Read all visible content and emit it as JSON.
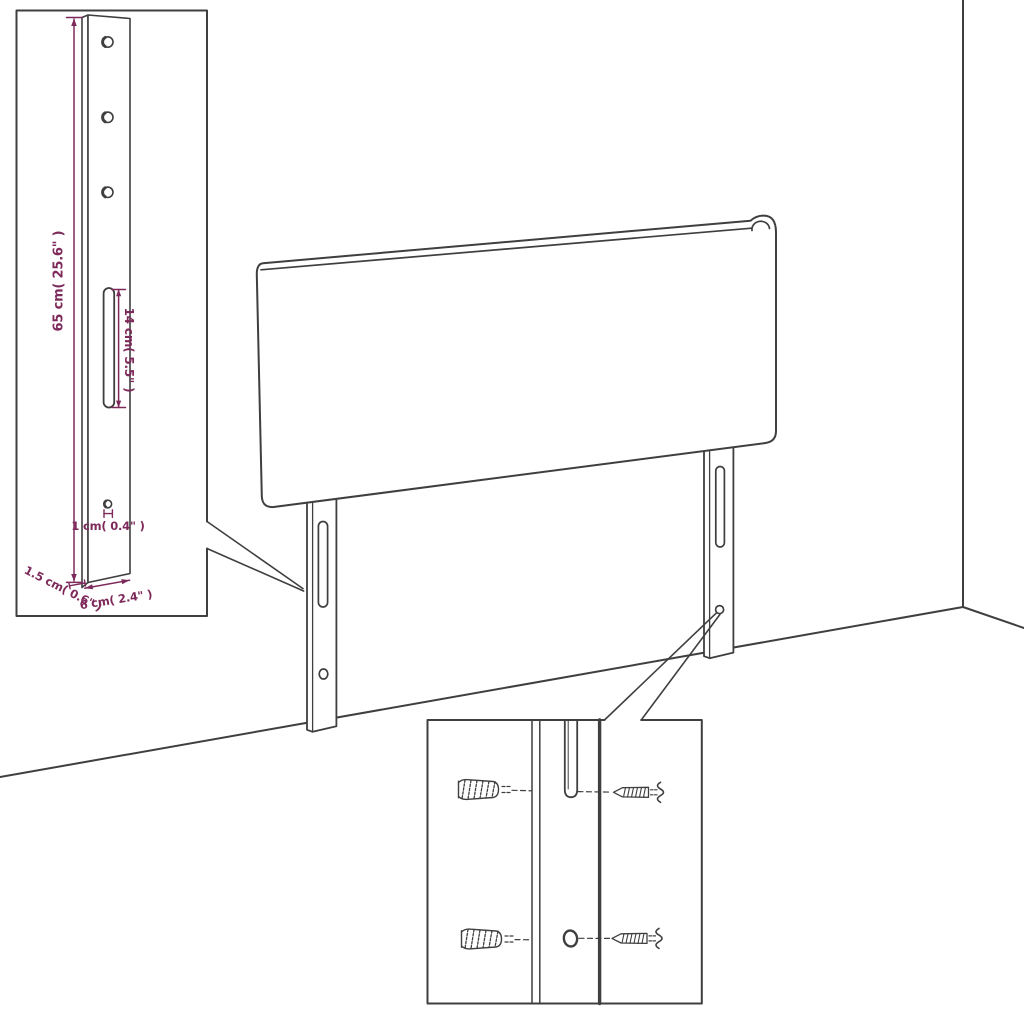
{
  "diagram": {
    "subject": "headboard-wall-mounting-diagram",
    "background": "#ffffff",
    "colors": {
      "line": "#3f3f3f",
      "dimension": "#7d2a5b"
    },
    "bracket_inset": {
      "dims": {
        "height": "65 cm( 25.6\" )",
        "slot": "14 cm( 5.5\" )",
        "hole": "1 cm( 0.4\" )",
        "thickness": "1.5 cm( 0.6\" )",
        "width": "6 cm( 2.4\" )"
      },
      "icons": [
        "mounting-hole-icon",
        "mounting-slot-icon"
      ]
    },
    "hardware_inset": {
      "icons": [
        "wall-plug-icon",
        "screw-icon",
        "leg-slot-icon",
        "leg-hole-icon"
      ]
    }
  }
}
